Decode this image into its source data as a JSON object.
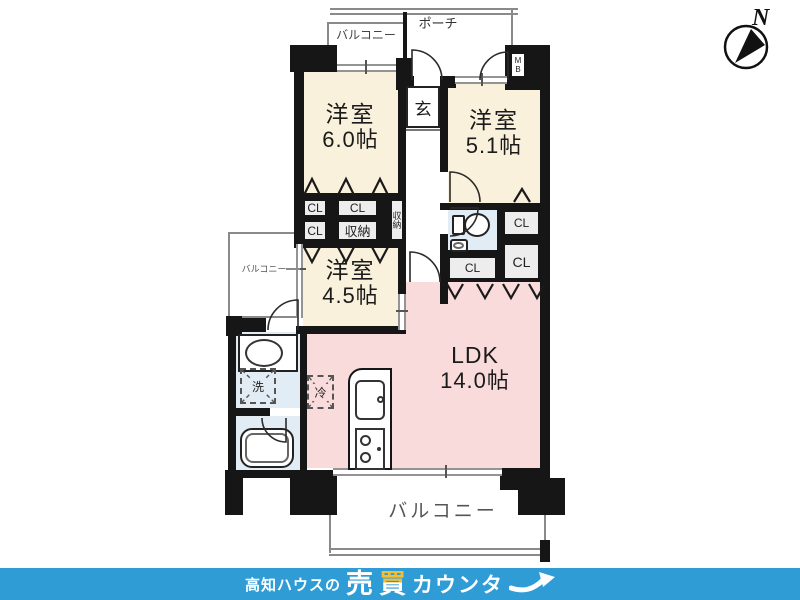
{
  "plan": {
    "rooms": {
      "bedroom1": {
        "name": "洋室",
        "size": "6.0帖"
      },
      "bedroom2": {
        "name": "洋室",
        "size": "5.1帖"
      },
      "bedroom3": {
        "name": "洋室",
        "size": "4.5帖"
      },
      "ldk": {
        "name": "LDK",
        "size": "14.0帖"
      },
      "entrance": "玄"
    },
    "labels": {
      "porch": "ポーチ",
      "balcony": "バルコニー",
      "meter_box": "MB",
      "closet": "CL",
      "storage": "収納",
      "washer": "洗",
      "fridge": "冷"
    }
  },
  "compass": {
    "north": "N"
  },
  "footer": {
    "prefix": "高知ハウスの",
    "main_1": "売",
    "main_2": "買",
    "suffix": "カウンタ"
  },
  "colors": {
    "wall": "#161616",
    "bedroom_cream": "#faf1dd",
    "ldk_pink": "#f9dbdc",
    "wet_area_blue": "#e2ecf4",
    "footer_blue": "#2f9cd6",
    "accent_yellow": "#f3be37"
  }
}
